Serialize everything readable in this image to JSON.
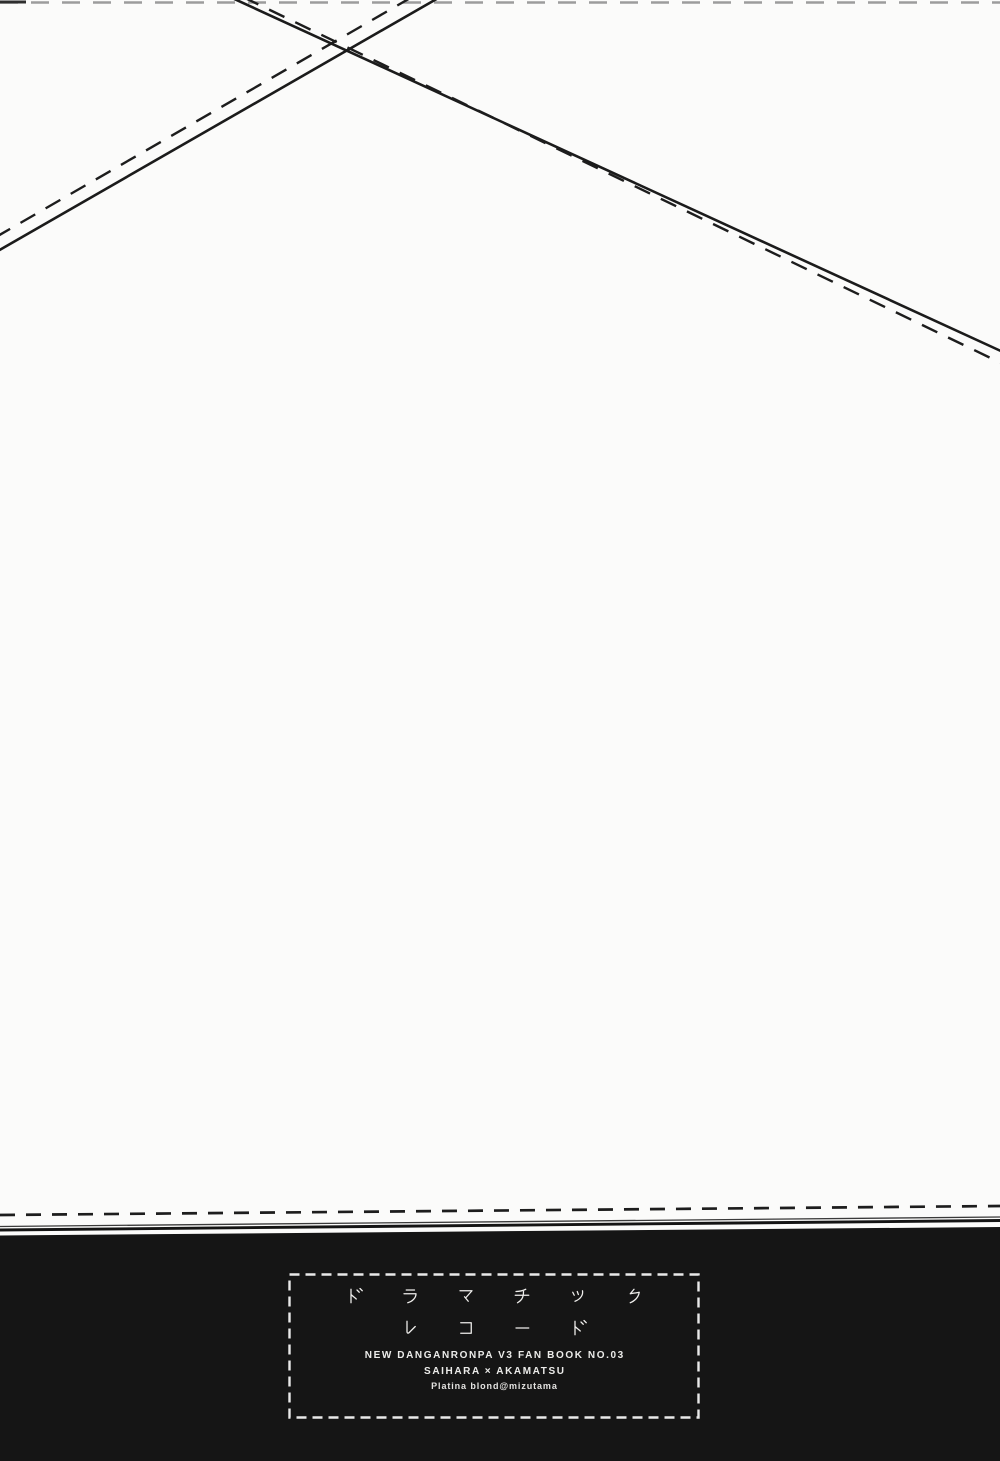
{
  "page": {
    "background": "#fbfbfa",
    "ink": "#1c1c1c"
  },
  "footer": {
    "band_color": "#151515",
    "box_border_color": "#e9e9e9",
    "text_color": "#efeeec",
    "title_line1": "ドラマチック",
    "title_line2": "レコード",
    "subtitle": "NEW DANGANRONPA V3 FAN BOOK NO.03",
    "pairing": "SAIHARA × AKAMATSU",
    "credit": "Platina blond@mizutama"
  }
}
